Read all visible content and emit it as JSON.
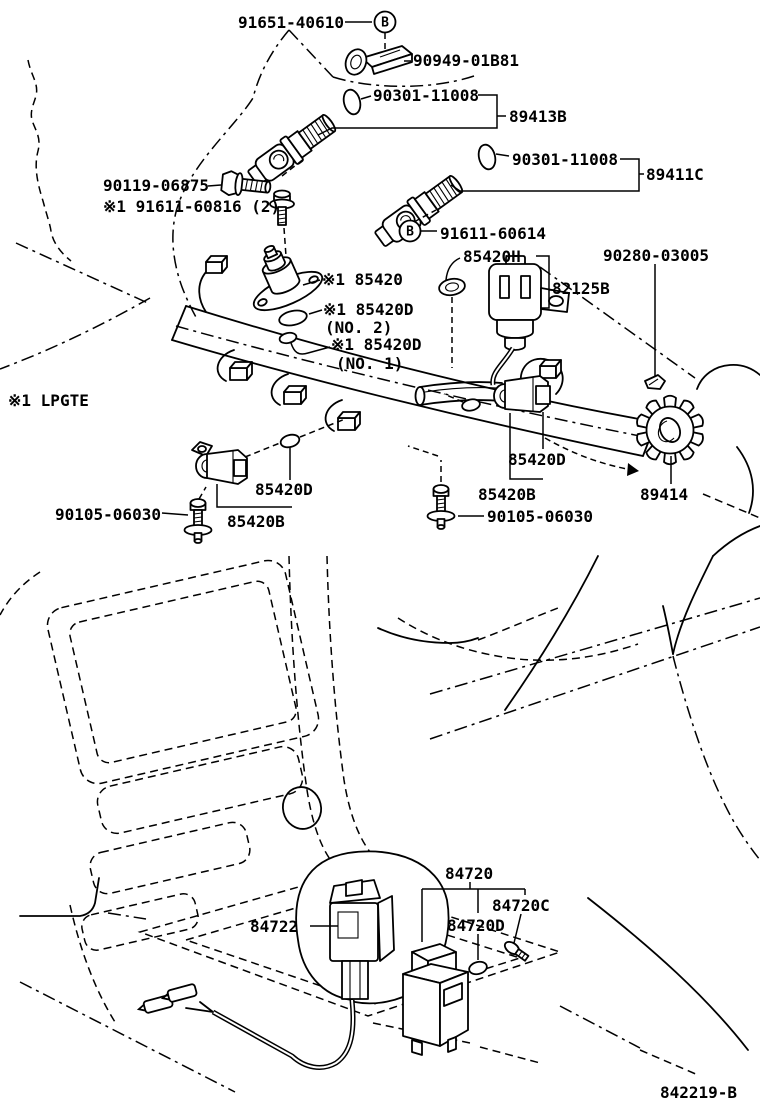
{
  "diagram": {
    "drawing_code": "842219-B",
    "footnote": "※1 LPGTE",
    "bolt_marker": "B",
    "labels": {
      "l91651_40610": "91651-40610",
      "l90949_01b81": "90949-01B81",
      "l90301_11008_upper": "90301-11008",
      "l89413b": "89413B",
      "l90301_11008_lower": "90301-11008",
      "l89411c": "89411C",
      "l90119_06875": "90119-06875",
      "l91611_60816": "※1 91611-60816 (2)",
      "l91611_60614": "91611-60614",
      "l85420h": "85420H",
      "l90280_03005": "90280-03005",
      "l82125b": "82125B",
      "l85420": "※1 85420",
      "l85420d_no2": "※1 85420D",
      "l85420d_no2_sub": "(NO. 2)",
      "l85420d_no1": "※1 85420D",
      "l85420d_no1_sub": "(NO. 1)",
      "l85420d_left": "85420D",
      "l90105_06030_left": "90105-06030",
      "l85420b_left": "85420B",
      "l85420d_center": "85420D",
      "l85420b_center": "85420B",
      "l90105_06030_center": "90105-06030",
      "l89414": "89414",
      "l84720": "84720",
      "l84720c": "84720C",
      "l84722": "84722",
      "l84720d": "84720D"
    }
  }
}
